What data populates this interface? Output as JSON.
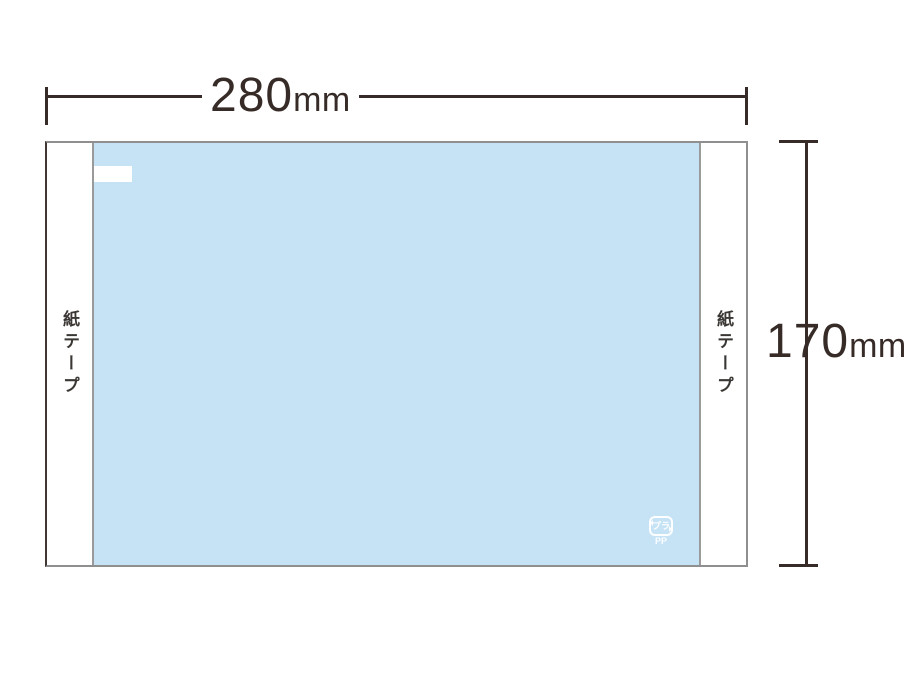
{
  "dimensions": {
    "width": {
      "value": "280",
      "unit": "mm"
    },
    "height": {
      "value": "170",
      "unit": "mm"
    }
  },
  "package": {
    "left_tape_label": "紙テープ",
    "right_tape_label": "紙テープ",
    "recycle_mark": {
      "inner_text": "プラ",
      "material_code": "PP"
    }
  },
  "colors": {
    "film_blue": "#c6e3f6",
    "dimension_line": "#362b27",
    "package_border_gray": "#8f8f8f",
    "package_border_left_dark": "#403733",
    "tape_separator_gray": "#9a9a9a",
    "tape_white": "#ffffff",
    "recycle_mark_white": "#ffffff"
  }
}
